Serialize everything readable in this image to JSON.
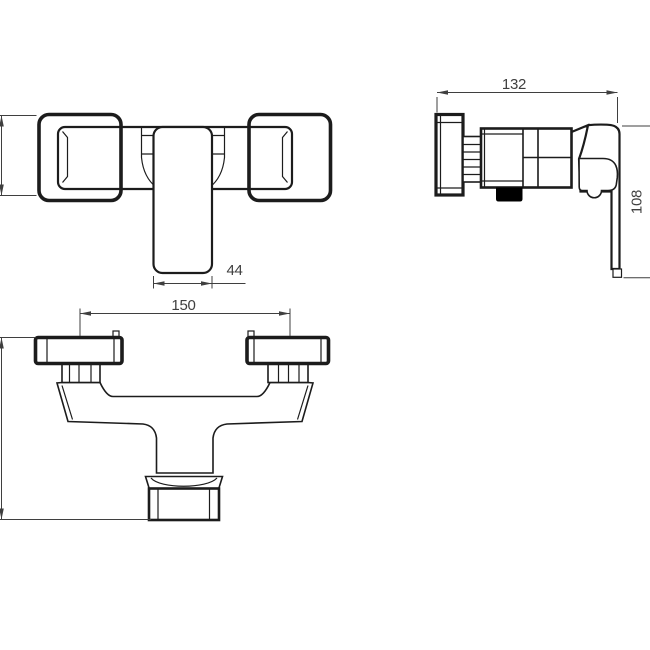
{
  "dimensions": {
    "body_width": "44",
    "connection_spacing": "150",
    "depth": "132",
    "height": "108"
  },
  "colors": {
    "background": "#ffffff",
    "line": "#1c1c1c",
    "dimension": "#3f3f3f",
    "outlet_fill": "#000000"
  }
}
